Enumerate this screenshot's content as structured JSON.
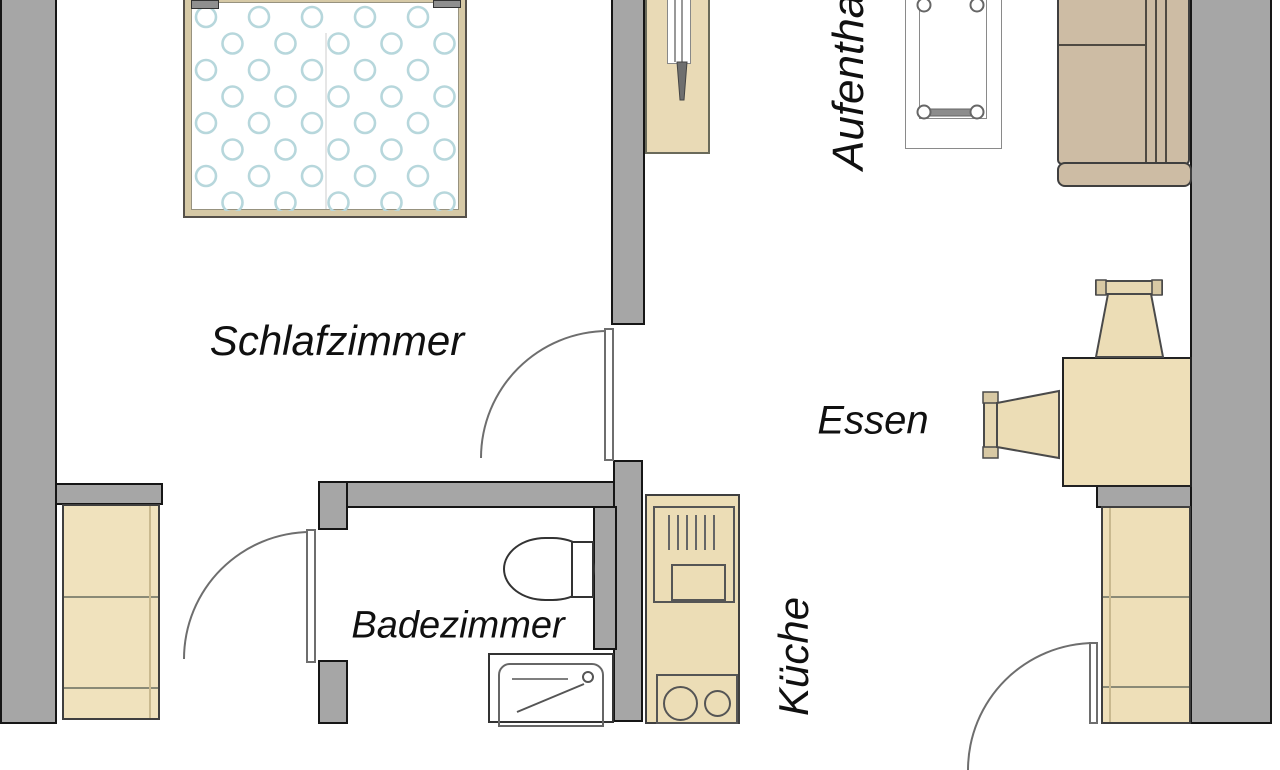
{
  "plan_title": "apartment-floor-plan",
  "labels": {
    "bedroom": "Schlafzimmer",
    "bathroom": "Badezimmer",
    "kitchen": "Küche",
    "dining": "Essen",
    "lounge": "Aufenthaltsraum"
  },
  "colors": {
    "wall_fill": "#a6a6a6",
    "wall_outline": "#161616",
    "furniture_beige": "#eedfb8",
    "wardrobe_beige": "#f0e2bd",
    "desk_beige": "#e9dab6",
    "bed_frame_tan": "#d6c9a6",
    "sofa_tan": "#cdbca4",
    "blanket_pattern_blue": "#b7d7dc",
    "label_text": "#101010",
    "door_line": "#6e6e6e",
    "floor": "#ffffff"
  }
}
